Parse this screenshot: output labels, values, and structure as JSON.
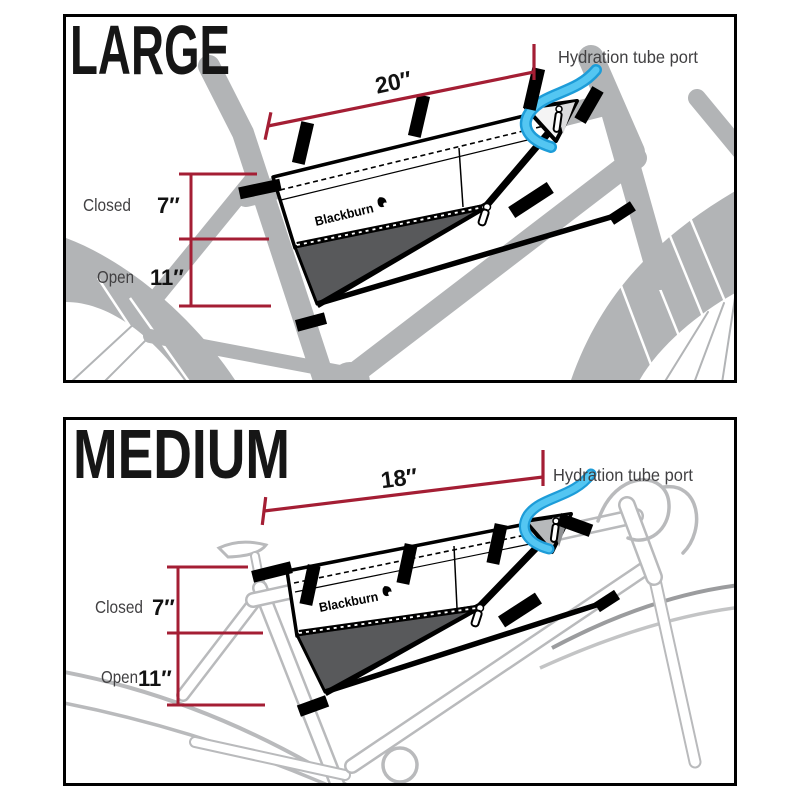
{
  "panels": [
    {
      "title": "LARGE",
      "width_label": "20″",
      "port_label": "Hydration tube port",
      "closed_label": "Closed",
      "closed_value": "7″",
      "open_label": "Open",
      "open_value": "11″",
      "brand": "Blackburn"
    },
    {
      "title": "MEDIUM",
      "width_label": "18″",
      "port_label": "Hydration tube port",
      "closed_label": "Closed",
      "closed_value": "7″",
      "open_label": "Open",
      "open_value": "11″",
      "brand": "Blackburn"
    }
  ],
  "colors": {
    "dimension_red": "#a41e34",
    "bike_gray": "#b2b4b6",
    "outline_gray": "#b9babc",
    "expansion_gray": "#58595b",
    "tube_blue": "#54c6f2",
    "tube_blue_dark": "#1d9cd8"
  }
}
